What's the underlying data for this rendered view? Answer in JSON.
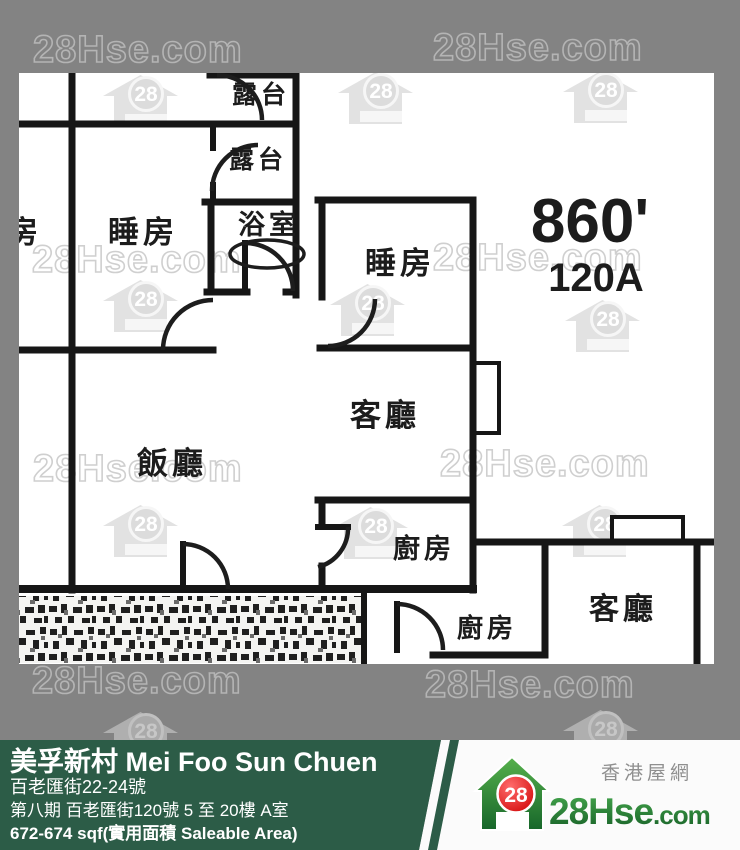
{
  "watermark": {
    "text": "28Hse.com",
    "logo_number": "28"
  },
  "plan": {
    "rooms": [
      {
        "id": "balcony-upper",
        "label": "露台"
      },
      {
        "id": "balcony-lower",
        "label": "露台"
      },
      {
        "id": "bedroom-neighbor",
        "label": "睡房"
      },
      {
        "id": "bedroom-left",
        "label": "睡房"
      },
      {
        "id": "bathroom",
        "label": "浴室"
      },
      {
        "id": "bedroom-right",
        "label": "睡房"
      },
      {
        "id": "living-room",
        "label": "客廳"
      },
      {
        "id": "dining-room",
        "label": "飯廳"
      },
      {
        "id": "kitchen",
        "label": "廚房"
      },
      {
        "id": "kitchen-lower",
        "label": "廚房"
      },
      {
        "id": "living-room-lower",
        "label": "客廳"
      }
    ],
    "area_label": "860'",
    "unit_label": "120A"
  },
  "footer": {
    "title": "美孚新村 Mei Foo Sun Chuen",
    "address": "百老匯街22-24號",
    "phase": "第八期 百老匯街120號 5 至 20樓 A室",
    "size": "672-674 sqf(實用面積 Saleable Area)",
    "colors": {
      "green": "#2c5c47",
      "gray": "#838383"
    }
  },
  "logo": {
    "number": "28",
    "name": "28Hse",
    "com": ".com",
    "tagline": "香港屋網"
  }
}
